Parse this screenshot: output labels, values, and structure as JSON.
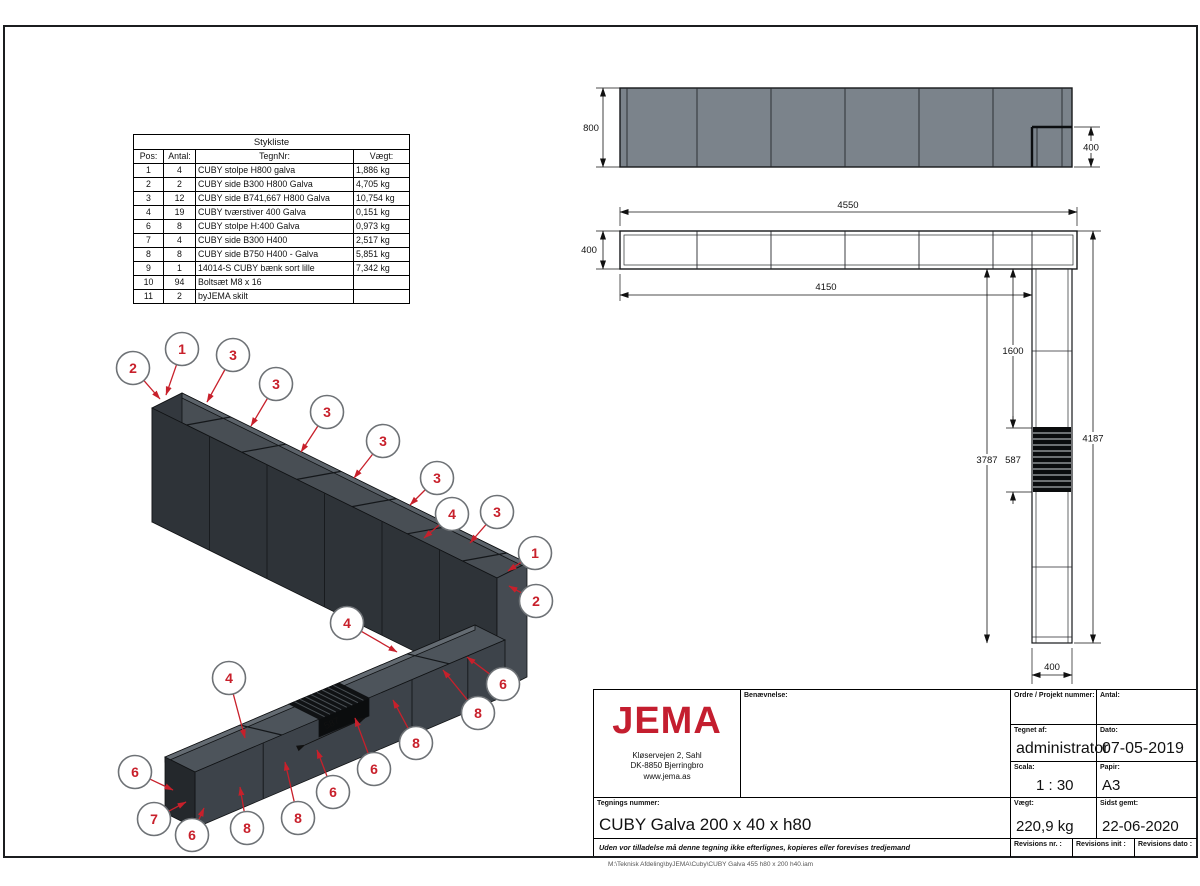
{
  "page": {
    "file_path": "M:\\Teknisk Afdeling\\byJEMA\\Cuby\\CUBY Galva 455 h80 x 200 h40.iam"
  },
  "parts_list": {
    "title": "Stykliste",
    "columns": [
      "Pos:",
      "Antal:",
      "TegnNr:",
      "Vægt:"
    ],
    "rows": [
      [
        "1",
        "4",
        "CUBY stolpe H800 galva",
        "1,886 kg"
      ],
      [
        "2",
        "2",
        "CUBY side B300 H800 Galva",
        "4,705 kg"
      ],
      [
        "3",
        "12",
        "CUBY side B741,667 H800 Galva",
        "10,754 kg"
      ],
      [
        "4",
        "19",
        "CUBY tværstiver 400 Galva",
        "0,151 kg"
      ],
      [
        "6",
        "8",
        "CUBY stolpe H:400 Galva",
        "0,973 kg"
      ],
      [
        "7",
        "4",
        "CUBY side B300 H400",
        "2,517 kg"
      ],
      [
        "8",
        "8",
        "CUBY side B750 H400 - Galva",
        "5,851 kg"
      ],
      [
        "9",
        "1",
        "14014-S CUBY bænk sort lille",
        "7,342 kg"
      ],
      [
        "10",
        "94",
        "Boltsæt M8 x 16",
        ""
      ],
      [
        "11",
        "2",
        "byJEMA skilt",
        ""
      ]
    ]
  },
  "title_block": {
    "logo_text": "JEMA",
    "address_lines": [
      "Kløservejen 2, Sahl",
      "DK-8850 Bjerringbro",
      "www.jema.as"
    ],
    "benaevnelse_label": "Benævnelse:",
    "ordre_label": "Ordre / Projekt nummer:",
    "antal_label": "Antal:",
    "tegnet_af_label": "Tegnet af:",
    "tegnet_af_value": "administrator",
    "dato_label": "Dato:",
    "dato_value": "07-05-2019",
    "scala_label": "Scala:",
    "scala_value": "1 : 30",
    "papir_label": "Papir:",
    "papir_value": "A3",
    "tegnings_nummer_label": "Tegnings nummer:",
    "tegnings_nummer_value": "CUBY Galva 200 x 40 x h80",
    "vaegt_label": "Vægt:",
    "vaegt_value": "220,9 kg",
    "sidst_gemt_label": "Sidst gemt:",
    "sidst_gemt_value": "22-06-2020",
    "revisions_nr_label": "Revisions nr. :",
    "revisions_init_label": "Revisions init :",
    "revisions_dato_label": "Revisions dato :",
    "disclaimer": "Uden vor tilladelse må denne tegning ikke efterlignes, kopieres eller forevises tredjemand"
  },
  "views": {
    "elevation": {
      "height": "800",
      "step_height": "400"
    },
    "plan": {
      "total_width": "4550",
      "depth": "400",
      "inner_width": "4150",
      "leg_upper": "1600",
      "leg_left_total": "3787",
      "bench_width": "587",
      "leg_overall": "4187",
      "leg_width": "400"
    },
    "iso": {
      "bench_gap": "587"
    }
  },
  "drawing": {
    "accent_red": "#c8202b",
    "steel_gray": "#7b838b",
    "iso_dark": "#2e3338",
    "balloons": [
      {
        "n": "2",
        "x": 133,
        "y": 368,
        "tx": 160,
        "ty": 399
      },
      {
        "n": "1",
        "x": 182,
        "y": 349,
        "tx": 166,
        "ty": 395
      },
      {
        "n": "3",
        "x": 233,
        "y": 355,
        "tx": 207,
        "ty": 402
      },
      {
        "n": "3",
        "x": 276,
        "y": 384,
        "tx": 251,
        "ty": 426
      },
      {
        "n": "3",
        "x": 327,
        "y": 412,
        "tx": 301,
        "ty": 452
      },
      {
        "n": "3",
        "x": 383,
        "y": 441,
        "tx": 354,
        "ty": 478
      },
      {
        "n": "3",
        "x": 437,
        "y": 478,
        "tx": 410,
        "ty": 505
      },
      {
        "n": "4",
        "x": 452,
        "y": 514,
        "tx": 424,
        "ty": 538
      },
      {
        "n": "3",
        "x": 497,
        "y": 512,
        "tx": 470,
        "ty": 543
      },
      {
        "n": "1",
        "x": 535,
        "y": 553,
        "tx": 508,
        "ty": 571
      },
      {
        "n": "2",
        "x": 536,
        "y": 601,
        "tx": 509,
        "ty": 586
      },
      {
        "n": "4",
        "x": 347,
        "y": 623,
        "tx": 397,
        "ty": 652
      },
      {
        "n": "6",
        "x": 503,
        "y": 684,
        "tx": 467,
        "ty": 657
      },
      {
        "n": "8",
        "x": 478,
        "y": 713,
        "tx": 443,
        "ty": 670
      },
      {
        "n": "8",
        "x": 416,
        "y": 743,
        "tx": 393,
        "ty": 700
      },
      {
        "n": "6",
        "x": 374,
        "y": 769,
        "tx": 355,
        "ty": 718
      },
      {
        "n": "6",
        "x": 333,
        "y": 792,
        "tx": 317,
        "ty": 750
      },
      {
        "n": "4",
        "x": 229,
        "y": 678,
        "tx": 245,
        "ty": 738
      },
      {
        "n": "6",
        "x": 135,
        "y": 772,
        "tx": 173,
        "ty": 790
      },
      {
        "n": "7",
        "x": 154,
        "y": 819,
        "tx": 186,
        "ty": 802
      },
      {
        "n": "6",
        "x": 192,
        "y": 835,
        "tx": 204,
        "ty": 808
      },
      {
        "n": "8",
        "x": 247,
        "y": 828,
        "tx": 240,
        "ty": 787
      },
      {
        "n": "8",
        "x": 298,
        "y": 818,
        "tx": 285,
        "ty": 762
      }
    ]
  }
}
